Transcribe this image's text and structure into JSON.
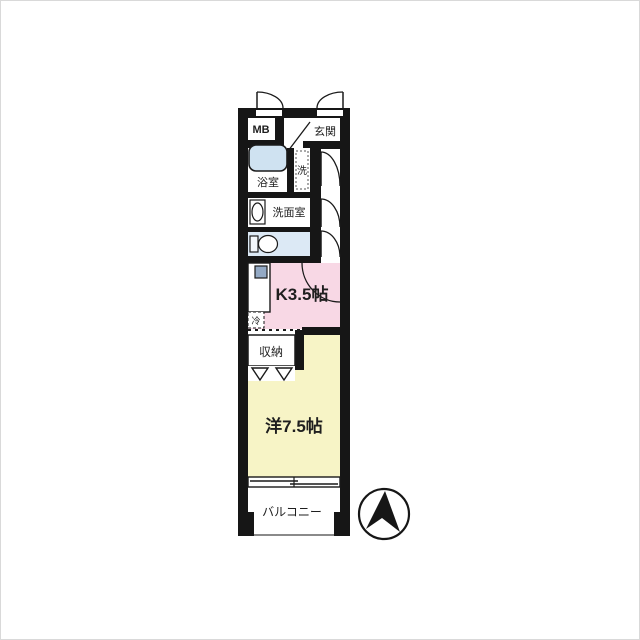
{
  "floorplan": {
    "rooms": {
      "mb": {
        "label": "MB"
      },
      "entrance": {
        "label": "玄関"
      },
      "bathroom": {
        "label": "浴室"
      },
      "laundry": {
        "label": "洗"
      },
      "washroom": {
        "label": "洗面室"
      },
      "kitchen": {
        "label": "K3.5帖"
      },
      "fridge": {
        "label": "冷"
      },
      "closet": {
        "label": "収納"
      },
      "western_room": {
        "label": "洋7.5帖"
      },
      "balcony": {
        "label": "バルコニー"
      }
    },
    "colors": {
      "wall": "#161616",
      "kitchen_fill": "#f8d8e5",
      "room_fill": "#f7f4c6",
      "bathtub_fill": "#cfe2f1",
      "toilet_room_fill": "#dce9f5",
      "floor_fill": "#ffffff",
      "sink_square_fill": "#93a9c4"
    },
    "compass": {
      "direction": "N"
    }
  }
}
